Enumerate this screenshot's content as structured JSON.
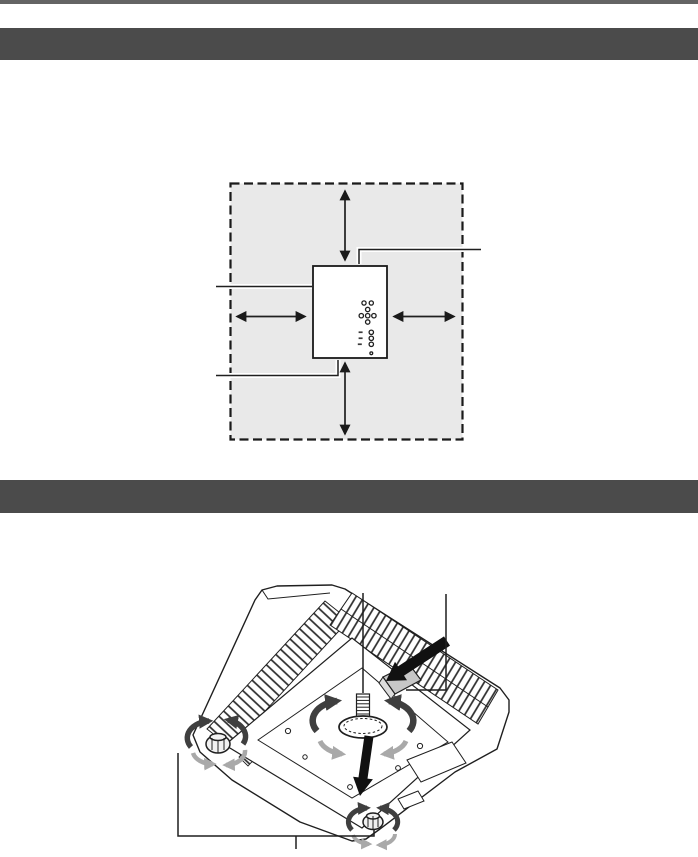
{
  "colors": {
    "page_bg": "#ffffff",
    "top_rule": "#646464",
    "section_bar": "#4b4b4b",
    "line": "#1f1f1f",
    "zone_fill": "#e9e9e9",
    "projector_fill": "#ffffff",
    "lever_fill": "#c7c7c7",
    "arrow_black": "#111111",
    "rotate_dark": "#3f3f3f",
    "rotate_light": "#a9a9a9"
  },
  "header_bars": [
    {
      "id": "section-bar-1",
      "text": ""
    },
    {
      "id": "section-bar-2",
      "text": ""
    }
  ],
  "figures": {
    "clearance": {
      "name": "installation-clearance-top-view",
      "zone": "dashed-boundary-with-gray-keep-clear-area",
      "elements": [
        "clearance-zone-dashed-boundary",
        "projector-top-view",
        "control-panel-buttons",
        "clearance-arrow-top",
        "clearance-arrow-bottom",
        "clearance-arrow-left",
        "clearance-arrow-right",
        "callout-line-top-right",
        "callout-line-left",
        "callout-line-bottom-left"
      ]
    },
    "feet": {
      "name": "projector-bottom-view-adjustable-feet",
      "elements": [
        "air-intake-exhaust-grilles",
        "bottom-panel",
        "front-adjustable-foot",
        "foot-rotation-arrows",
        "press-down-arrow",
        "foot-lock-lever",
        "lever-press-arrow",
        "rear-adjustable-foot-left",
        "rear-adjustable-foot-right",
        "callout-front-foot",
        "callout-lock-lever",
        "rear-feet-callout-bracket"
      ]
    }
  }
}
